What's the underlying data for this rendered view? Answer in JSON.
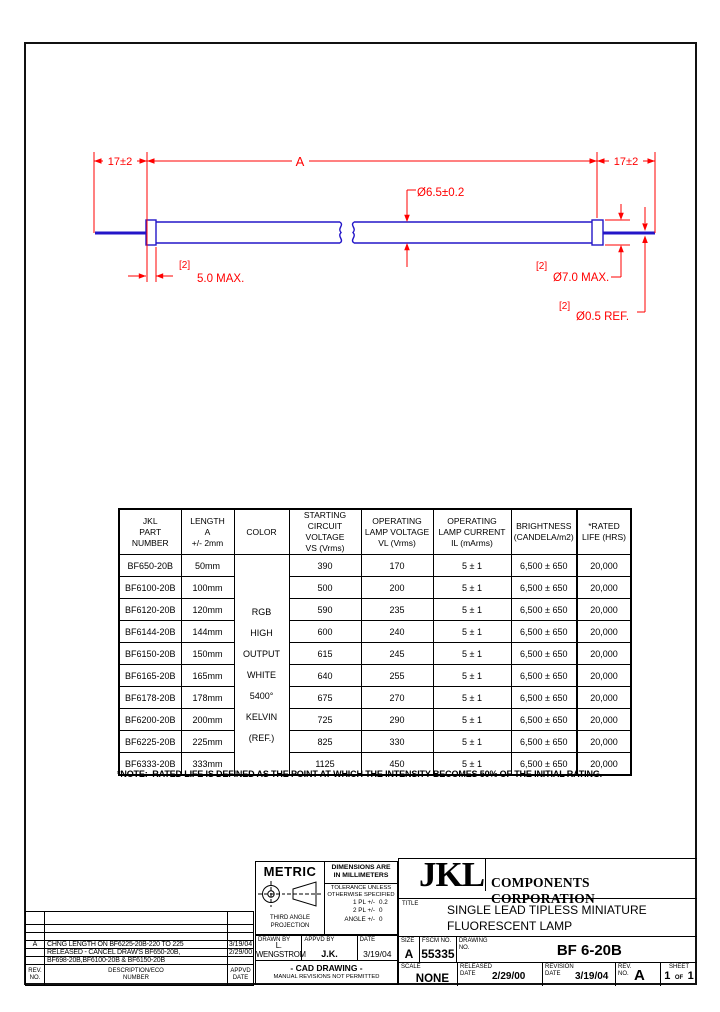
{
  "colors": {
    "dimension_red": "#ff0000",
    "lamp_blue": "#2316c8",
    "line_black": "#000000"
  },
  "drawing": {
    "dim_lead_left": "17±2",
    "dim_length": "A",
    "dim_lead_right": "17±2",
    "dia_tube": "Ø6.5±0.2",
    "qty_cap": "[2]",
    "cap_length": "5.0 MAX.",
    "qty_cap_dia": "[2]",
    "dia_cap": "Ø7.0 MAX.",
    "qty_lead_dia": "[2]",
    "dia_lead": "Ø0.5 REF."
  },
  "table": {
    "headers": [
      "JKL\nPART\nNUMBER",
      "LENGTH\nA\n+/- 2mm",
      "COLOR",
      "STARTING\nCIRCUIT VOLTAGE\nVS (Vrms)",
      "OPERATING\nLAMP VOLTAGE\nVL (Vrms)",
      "OPERATING\nLAMP CURRENT\nIL (mArms)",
      "BRIGHTNESS\n(CANDELA/m2)",
      "*RATED\nLIFE (HRS)"
    ],
    "color_label": "RGB\nHIGH\nOUTPUT\nWHITE\n5400°\nKELVIN\n(REF.)",
    "rows": [
      {
        "part": "BF650-20B",
        "length": "50mm",
        "vs": "390",
        "vl": "170",
        "il": "5 ± 1",
        "brightness": "6,500 ± 650",
        "life": "20,000"
      },
      {
        "part": "BF6100-20B",
        "length": "100mm",
        "vs": "500",
        "vl": "200",
        "il": "5 ± 1",
        "brightness": "6,500 ± 650",
        "life": "20,000"
      },
      {
        "part": "BF6120-20B",
        "length": "120mm",
        "vs": "590",
        "vl": "235",
        "il": "5 ± 1",
        "brightness": "6,500 ± 650",
        "life": "20,000"
      },
      {
        "part": "BF6144-20B",
        "length": "144mm",
        "vs": "600",
        "vl": "240",
        "il": "5 ± 1",
        "brightness": "6,500 ± 650",
        "life": "20,000"
      },
      {
        "part": "BF6150-20B",
        "length": "150mm",
        "vs": "615",
        "vl": "245",
        "il": "5 ± 1",
        "brightness": "6,500 ± 650",
        "life": "20,000"
      },
      {
        "part": "BF6165-20B",
        "length": "165mm",
        "vs": "640",
        "vl": "255",
        "il": "5 ± 1",
        "brightness": "6,500 ± 650",
        "life": "20,000"
      },
      {
        "part": "BF6178-20B",
        "length": "178mm",
        "vs": "675",
        "vl": "270",
        "il": "5 ± 1",
        "brightness": "6,500 ± 650",
        "life": "20,000"
      },
      {
        "part": "BF6200-20B",
        "length": "200mm",
        "vs": "725",
        "vl": "290",
        "il": "5 ± 1",
        "brightness": "6,500 ± 650",
        "life": "20,000"
      },
      {
        "part": "BF6225-20B",
        "length": "225mm",
        "vs": "825",
        "vl": "330",
        "il": "5 ± 1",
        "brightness": "6,500 ± 650",
        "life": "20,000"
      },
      {
        "part": "BF6333-20B",
        "length": "333mm",
        "vs": "1125",
        "vl": "450",
        "il": "5 ± 1",
        "brightness": "6,500 ± 650",
        "life": "20,000"
      }
    ]
  },
  "note": "*NOTE:  RATED LIFE IS DEFINED AS THE POINT AT WHICH THE INTENSITY BECOMES 50% OF THE INITIAL RATING.",
  "revisions": {
    "rows": [
      {
        "rev": "A",
        "description": "CHNG LENGTH ON BF6225-20B-220 TO 225",
        "date": "3/19/04"
      },
      {
        "rev": "",
        "description": "RELEASED - CANCEL DRAW'S BF650-20B,",
        "date": "2/29/00"
      },
      {
        "rev": "",
        "description": "BF698-20B,BF6100-20B & BF6150-20B",
        "date": ""
      }
    ],
    "header": {
      "rev": "REV.\nNO.",
      "description": "DESCRIPTION/ECO\nNUMBER",
      "date": "APPVD\nDATE"
    }
  },
  "title_block": {
    "metric": "METRIC",
    "projection": "THIRD ANGLE\nPROJECTION",
    "dims_note": "DIMENSIONS ARE\nIN MILLIMETERS",
    "tolerance": "TOLERANCE UNLESS\nOTHERWISE SPECIFIED",
    "tol_rows": [
      {
        "label": "1 PL +/-",
        "value": "0.2"
      },
      {
        "label": "2 PL +/-",
        "value": "0"
      },
      {
        "label": "ANGLE +/-",
        "value": "0"
      }
    ],
    "logo": "JKL",
    "company": "COMPONENTS CORPORATION",
    "title_label": "TITLE",
    "title": "SINGLE LEAD TIPLESS MINIATURE\nFLUORESCENT LAMP",
    "drawn_by_label": "DRAWN BY",
    "drawn_by": "L. WENGSTROM",
    "appvd_by_label": "APPVD BY",
    "appvd_by": "J.K.",
    "date_label": "DATE",
    "date": "3/19/04",
    "cad_line1": "- CAD DRAWING -",
    "cad_line2": "MANUAL REVISIONS NOT PERMITTED",
    "size_label": "SIZE",
    "size": "A",
    "fscm_label": "FSCM NO.",
    "fscm": "55335",
    "drawing_no_label": "DRAWING\nNO.",
    "drawing_no": "BF 6-20B",
    "scale_label": "SCALE",
    "scale": "NONE",
    "released_label": "RELEASED\nDATE",
    "released_date": "2/29/00",
    "revision_label": "REVISION\nDATE",
    "revision_date": "3/19/04",
    "rev_label": "REV.\nNO.",
    "rev": "A",
    "sheet_label": "SHEET",
    "sheet_num": "1",
    "sheet_of": "OF",
    "sheet_total": "1"
  }
}
